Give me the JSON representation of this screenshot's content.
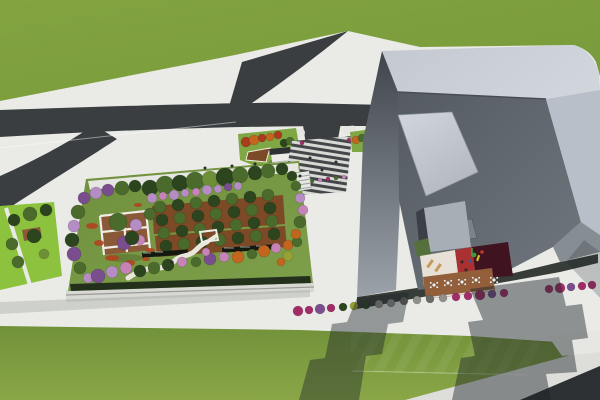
{
  "scene": {
    "description": "Aerial 3D architectural rendering: long building with rooftop garden at left, sculptural gray tower with inner courtyard at right, roads forking through green fields",
    "render_style": "photoreal-3d",
    "contains_text": false
  },
  "palette": {
    "pavement": "#EAEBE7",
    "pavementShade": "#DDDEDA",
    "road": "#3B3E41",
    "roadDark": "#2E3134",
    "plazaDark": "#44474A",
    "plazaLight": "#D8D9D5",
    "grassTop": "#7FA03F",
    "grassBottom": "#7C9C3D",
    "grassLime": "#8CC23E",
    "verdeGreen": "#7FA845",
    "lawn": "#6F8F3C",
    "walkWhite": "#E6E7E2",
    "pathWhite": "#E9E6DB",
    "hedge": "#22301C",
    "hedgeBar": "#15190F",
    "orchard": "#7C4A26",
    "deckBrown": "#8A5A38",
    "pergolaWhite": "#EFEDE6",
    "fascia": "#D8D9D4",
    "plinth": "#383D39",
    "roofBand": "#C9CED6",
    "roofBandRight": "#B9BFC8",
    "innerSlopeDark": "#545B61",
    "innerSlopeLight": "#70777E",
    "wallTop": "#3F454B",
    "wallBottom": "#9BA2AA",
    "skylight": "#CDD1D8",
    "panelGray": "#7B828A",
    "litWall": "#A8AEB5",
    "jambDark": "#3A4045",
    "courtCream": "#E7E0D6",
    "courtRed": "#A93132",
    "courtMaroon": "#401320",
    "courtDeck": "#935F3B",
    "tableWhite": "#F2F2F0",
    "loungerTan": "#C49A5E",
    "greenPatch": "#55703A",
    "flowerRed": "#B4401E",
    "shelterRoof": "#2E3133",
    "shelterWall": "#ECEBE6",
    "treeDark": "#2C451F",
    "treeGreen": "#4A6B2B",
    "treeLight": "#6C8F37",
    "treeYellow": "#96A334",
    "treePurple": "#7A4E8E",
    "treeLilac": "#B58CC4",
    "treePink": "#C583B8",
    "treeOrange": "#C2661F",
    "treeRed": "#A83C1C",
    "shrubMagenta": "#A22C68",
    "shrubPurple": "#7A4E8E",
    "shrubGray": "#8F8F8B",
    "shrubDark": "#6B6B66",
    "personDot": "#2E2E2E",
    "playGreen": "#3E9A3E",
    "playYellow": "#D9C22C",
    "playRed": "#C03A2A",
    "playBlue": "#2E5FA8"
  },
  "clusters": [
    {
      "target": "garden-trees",
      "items": [
        [
          150,
          188,
          8,
          "treeDark"
        ],
        [
          165,
          185,
          9,
          "treeGreen"
        ],
        [
          180,
          183,
          8,
          "treeDark"
        ],
        [
          195,
          181,
          9,
          "treeGreen"
        ],
        [
          210,
          179,
          8,
          "treeLight"
        ],
        [
          225,
          177,
          9,
          "treeDark"
        ],
        [
          240,
          175,
          8,
          "treeGreen"
        ],
        [
          255,
          173,
          7,
          "treeDark"
        ],
        [
          268,
          171,
          7,
          "treeGreen"
        ],
        [
          282,
          169,
          6,
          "treeDark"
        ],
        [
          96,
          193,
          6,
          "treeLilac"
        ],
        [
          108,
          190,
          6,
          "treePurple"
        ],
        [
          122,
          188,
          7,
          "treeGreen"
        ],
        [
          135,
          186,
          6,
          "treeDark"
        ],
        [
          152,
          198,
          5,
          "treeLilac"
        ],
        [
          163,
          196,
          4,
          "treePink"
        ],
        [
          174,
          195,
          5,
          "treeLilac"
        ],
        [
          185,
          193,
          4,
          "treeLilac"
        ],
        [
          196,
          192,
          4,
          "treePink"
        ],
        [
          207,
          190,
          5,
          "treeLilac"
        ],
        [
          218,
          189,
          4,
          "treeLilac"
        ],
        [
          228,
          187,
          4,
          "treePurple"
        ],
        [
          238,
          186,
          4,
          "treeLilac"
        ],
        [
          84,
          198,
          6,
          "treePurple"
        ],
        [
          78,
          212,
          7,
          "treeGreen"
        ],
        [
          74,
          226,
          6,
          "treeLilac"
        ],
        [
          72,
          240,
          7,
          "treeDark"
        ],
        [
          74,
          254,
          7,
          "treePurple"
        ],
        [
          80,
          268,
          6,
          "treeGreen"
        ],
        [
          88,
          278,
          5,
          "treeLilac"
        ],
        [
          98,
          276,
          7,
          "treePurple"
        ],
        [
          112,
          272,
          6,
          "treeLilac"
        ],
        [
          126,
          268,
          6,
          "treePink"
        ],
        [
          140,
          271,
          6,
          "treeDark"
        ],
        [
          154,
          268,
          6,
          "treeGreen"
        ],
        [
          168,
          265,
          6,
          "treeDark"
        ],
        [
          182,
          262,
          5,
          "treePink"
        ],
        [
          196,
          262,
          5,
          "treeGreen"
        ],
        [
          210,
          259,
          6,
          "treePurple"
        ],
        [
          224,
          257,
          5,
          "treePink"
        ],
        [
          238,
          257,
          6,
          "treeOrange"
        ],
        [
          252,
          254,
          5,
          "treeGreen"
        ],
        [
          264,
          251,
          6,
          "treeOrange"
        ],
        [
          276,
          248,
          5,
          "treePink"
        ],
        [
          288,
          245,
          5,
          "treeOrange"
        ],
        [
          297,
          242,
          5,
          "treeGreen"
        ],
        [
          296,
          234,
          5,
          "treeOrange"
        ],
        [
          300,
          222,
          6,
          "treeGreen"
        ],
        [
          303,
          210,
          5,
          "treePink"
        ],
        [
          300,
          198,
          5,
          "treeLilac"
        ],
        [
          296,
          186,
          5,
          "treeGreen"
        ],
        [
          292,
          176,
          5,
          "treeDark"
        ],
        [
          150,
          214,
          6,
          "treeGreen"
        ],
        [
          136,
          225,
          6,
          "treeLilac"
        ],
        [
          124,
          243,
          7,
          "treePurple"
        ],
        [
          140,
          240,
          5,
          "treePink"
        ],
        [
          206,
          252,
          4,
          "treePink"
        ],
        [
          288,
          256,
          5,
          "treeYellow"
        ],
        [
          281,
          262,
          4,
          "treeOrange"
        ],
        [
          118,
          222,
          9,
          "treeGreen"
        ],
        [
          132,
          238,
          7,
          "treeDark"
        ]
      ]
    },
    {
      "target": "orchard-trees",
      "items": [
        [
          160,
          207,
          6,
          "treeGreen"
        ],
        [
          178,
          205,
          6,
          "treeDark"
        ],
        [
          196,
          203,
          6,
          "treeGreen"
        ],
        [
          214,
          201,
          6,
          "treeDark"
        ],
        [
          232,
          199,
          6,
          "treeGreen"
        ],
        [
          250,
          197,
          6,
          "treeDark"
        ],
        [
          268,
          195,
          6,
          "treeGreen"
        ],
        [
          162,
          220,
          6,
          "treeDark"
        ],
        [
          180,
          218,
          6,
          "treeGreen"
        ],
        [
          198,
          216,
          6,
          "treeDark"
        ],
        [
          216,
          214,
          6,
          "treeGreen"
        ],
        [
          234,
          212,
          6,
          "treeDark"
        ],
        [
          252,
          210,
          6,
          "treeGreen"
        ],
        [
          270,
          208,
          6,
          "treeDark"
        ],
        [
          164,
          233,
          6,
          "treeGreen"
        ],
        [
          182,
          231,
          6,
          "treeDark"
        ],
        [
          200,
          229,
          6,
          "treeGreen"
        ],
        [
          218,
          227,
          6,
          "treeDark"
        ],
        [
          236,
          225,
          6,
          "treeGreen"
        ],
        [
          254,
          223,
          6,
          "treeDark"
        ],
        [
          272,
          221,
          6,
          "treeGreen"
        ],
        [
          166,
          246,
          6,
          "treeDark"
        ],
        [
          184,
          244,
          6,
          "treeGreen"
        ],
        [
          202,
          242,
          6,
          "treeDark"
        ],
        [
          220,
          240,
          6,
          "treeGreen"
        ],
        [
          238,
          238,
          6,
          "treeDark"
        ],
        [
          256,
          236,
          6,
          "treeGreen"
        ],
        [
          274,
          234,
          6,
          "treeDark"
        ]
      ]
    },
    {
      "target": "lime-trees",
      "items": [
        [
          14,
          220,
          6,
          "treeDark"
        ],
        [
          30,
          214,
          7,
          "treeGreen"
        ],
        [
          46,
          210,
          6,
          "treeDark"
        ],
        [
          12,
          244,
          6,
          "treeGreen"
        ],
        [
          34,
          236,
          7,
          "treeDark"
        ],
        [
          18,
          262,
          6,
          "treeGreen"
        ],
        [
          44,
          254,
          5,
          "treeLight"
        ]
      ]
    },
    {
      "target": "pocket-trees",
      "items": [
        [
          246,
          142,
          5,
          "treeRed"
        ],
        [
          254,
          140,
          5,
          "treeOrange"
        ],
        [
          262,
          138,
          4,
          "treeRed"
        ],
        [
          270,
          137,
          4,
          "treeOrange"
        ],
        [
          278,
          135,
          4,
          "treeRed"
        ],
        [
          284,
          143,
          4,
          "treeDark"
        ],
        [
          290,
          141,
          4,
          "treeGreen"
        ]
      ]
    },
    {
      "target": "verge-trees",
      "items": [
        [
          356,
          140,
          4,
          "treeOrange"
        ],
        [
          362,
          138,
          4,
          "treeGreen"
        ],
        [
          368,
          136,
          3,
          "treePurple"
        ],
        [
          376,
          126,
          4,
          "treeOrange"
        ],
        [
          383,
          124,
          4,
          "treeGreen"
        ]
      ]
    },
    {
      "target": "street-shrubs",
      "items": [
        [
          298,
          311,
          5,
          "shrubMagenta"
        ],
        [
          309,
          310,
          4,
          "shrubMagenta"
        ],
        [
          320,
          309,
          5,
          "shrubPurple"
        ],
        [
          331,
          308,
          4,
          "shrubMagenta"
        ],
        [
          343,
          307,
          4,
          "treeDark"
        ],
        [
          354,
          306,
          4,
          "treeYellow"
        ],
        [
          366,
          305,
          4,
          "treeDark"
        ],
        [
          379,
          304,
          4,
          "shrubGray"
        ],
        [
          391,
          303,
          4,
          "shrubGray"
        ],
        [
          404,
          301,
          4,
          "shrubDark"
        ],
        [
          417,
          300,
          4,
          "shrubGray"
        ],
        [
          430,
          299,
          4,
          "shrubDark"
        ],
        [
          443,
          298,
          4,
          "shrubGray"
        ],
        [
          456,
          297,
          4,
          "shrubMagenta"
        ],
        [
          468,
          296,
          4,
          "shrubMagenta"
        ],
        [
          480,
          295,
          5,
          "shrubMagenta"
        ],
        [
          492,
          294,
          4,
          "shrubPurple"
        ],
        [
          504,
          293,
          4,
          "shrubMagenta"
        ],
        [
          549,
          289,
          4,
          "shrubMagenta"
        ],
        [
          560,
          288,
          5,
          "shrubMagenta"
        ],
        [
          571,
          287,
          4,
          "shrubPurple"
        ],
        [
          582,
          286,
          4,
          "shrubMagenta"
        ],
        [
          592,
          285,
          4,
          "shrubMagenta"
        ]
      ]
    },
    {
      "target": "plaza-flowers",
      "items": [
        [
          305,
          182,
          2,
          "shrubMagenta"
        ],
        [
          312,
          181,
          2,
          "treeGreen"
        ],
        [
          320,
          180,
          2,
          "treePink"
        ],
        [
          328,
          179,
          2,
          "shrubMagenta"
        ],
        [
          336,
          178,
          2,
          "treeGreen"
        ],
        [
          344,
          177,
          2,
          "treePink"
        ],
        [
          302,
          143,
          2,
          "shrubMagenta"
        ],
        [
          349,
          140,
          2,
          "shrubMagenta"
        ],
        [
          357,
          147,
          2,
          "treePink"
        ],
        [
          365,
          145,
          2,
          "shrubMagenta"
        ]
      ]
    }
  ],
  "flower_patches": [
    [
      92,
      226,
      6,
      3
    ],
    [
      99,
      243,
      5,
      3
    ],
    [
      112,
      258,
      7,
      3
    ],
    [
      130,
      263,
      5,
      3
    ],
    [
      146,
      259,
      4,
      2
    ],
    [
      138,
      205,
      4,
      2
    ],
    [
      150,
      250,
      5,
      2
    ]
  ],
  "people": [
    [
      205,
      168
    ],
    [
      232,
      166
    ],
    [
      255,
      164
    ],
    [
      310,
      158
    ],
    [
      322,
      170
    ],
    [
      336,
      162
    ],
    [
      172,
      262
    ],
    [
      462,
      262
    ],
    [
      466,
      270
    ],
    [
      300,
      176
    ]
  ],
  "court_tables": [
    [
      434,
      285
    ],
    [
      448,
      283
    ],
    [
      462,
      282
    ],
    [
      476,
      280
    ],
    [
      494,
      280
    ]
  ]
}
